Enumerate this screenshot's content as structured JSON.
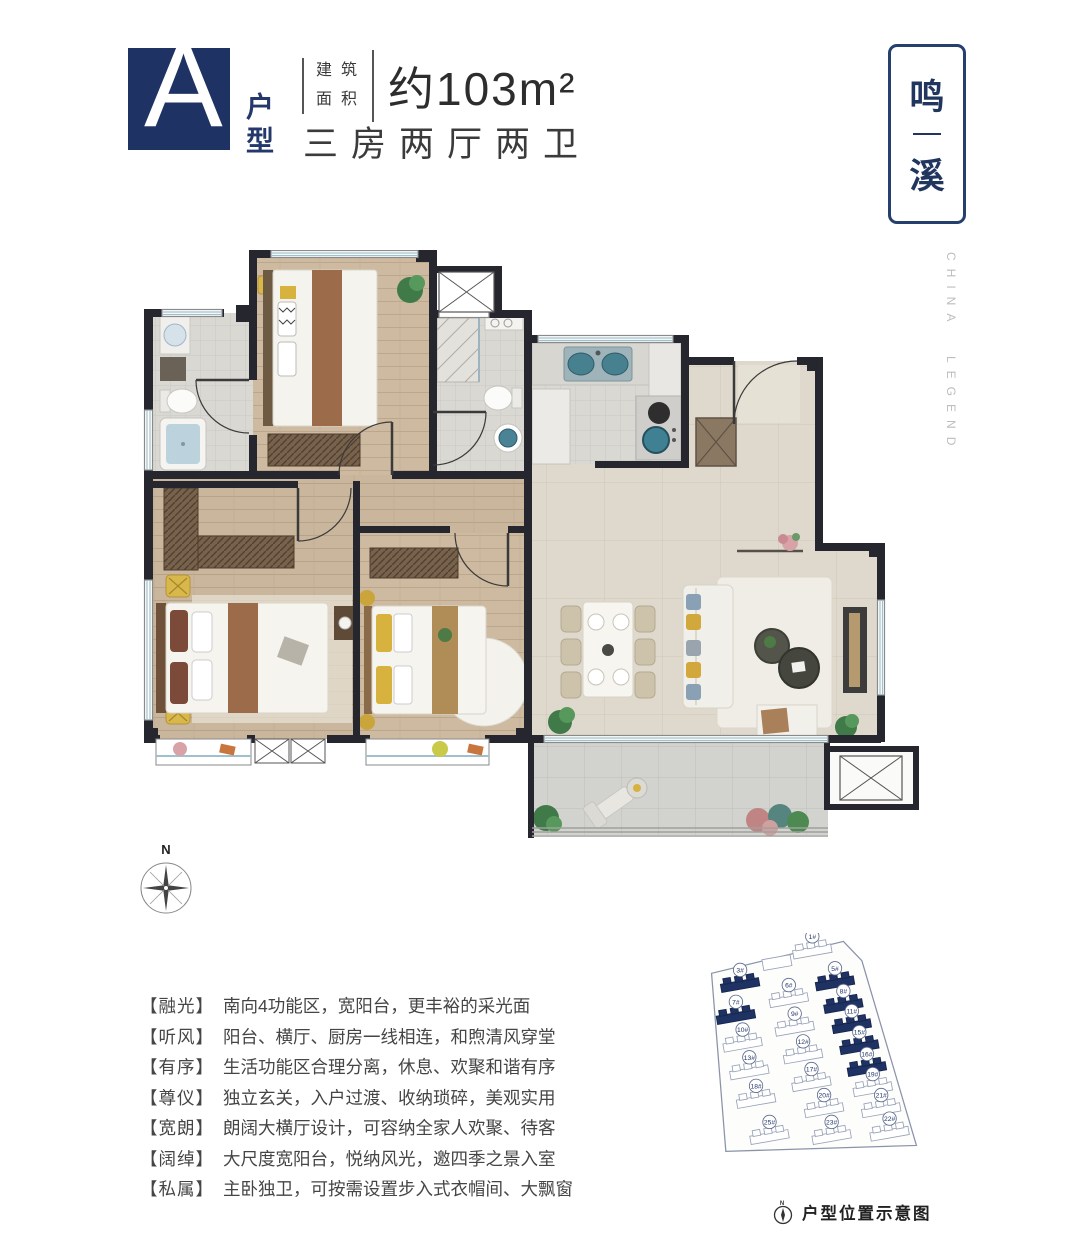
{
  "header": {
    "unit_letter": "A",
    "unit_type": "户型",
    "area_label_line1": "建筑",
    "area_label_line2": "面积",
    "area_value": "约103m²",
    "layout_text": "三房两厅两卫"
  },
  "brand": {
    "name_char1": "鸣",
    "name_char2": "溪",
    "side_text": "CHINA LEGEND"
  },
  "floorplan": {
    "compass_label": "N"
  },
  "features": [
    {
      "tag": "【融光】",
      "text": "南向4功能区，宽阳台，更丰裕的采光面"
    },
    {
      "tag": "【听风】",
      "text": "阳台、横厅、厨房一线相连，和煦清风穿堂"
    },
    {
      "tag": "【有序】",
      "text": "生活功能区合理分离，休息、欢聚和谐有序"
    },
    {
      "tag": "【尊仪】",
      "text": "独立玄关，入户过渡、收纳琐碎，美观实用"
    },
    {
      "tag": "【宽朗】",
      "text": "朗阔大横厅设计，可容纳全家人欢聚、待客"
    },
    {
      "tag": "【阔绰】",
      "text": "大尺度宽阳台，悦纳风光，邀四季之景入室"
    },
    {
      "tag": "【私属】",
      "text": "主卧独卫，可按需设置步入式衣帽间、大飘窗"
    }
  ],
  "siteplan": {
    "caption": "户型位置示意图",
    "compass_label": "N",
    "buildings": [
      {
        "label": "1#",
        "x": 148,
        "y": 22,
        "highlighted": false
      },
      {
        "label": "3#",
        "x": 62,
        "y": 62,
        "highlighted": true
      },
      {
        "label": "5#",
        "x": 175,
        "y": 60,
        "highlighted": true
      },
      {
        "label": "6#",
        "x": 120,
        "y": 80,
        "highlighted": false
      },
      {
        "label": "7#",
        "x": 57,
        "y": 100,
        "highlighted": true
      },
      {
        "label": "8#",
        "x": 185,
        "y": 87,
        "highlighted": true
      },
      {
        "label": "9#",
        "x": 127,
        "y": 114,
        "highlighted": false
      },
      {
        "label": "10#",
        "x": 65,
        "y": 133,
        "highlighted": false
      },
      {
        "label": "11#",
        "x": 195,
        "y": 111,
        "highlighted": true
      },
      {
        "label": "12#",
        "x": 137,
        "y": 147,
        "highlighted": false
      },
      {
        "label": "13#",
        "x": 73,
        "y": 166,
        "highlighted": false
      },
      {
        "label": "15#",
        "x": 204,
        "y": 136,
        "highlighted": true
      },
      {
        "label": "16#",
        "x": 213,
        "y": 162,
        "highlighted": true
      },
      {
        "label": "17#",
        "x": 147,
        "y": 180,
        "highlighted": false
      },
      {
        "label": "18#",
        "x": 81,
        "y": 200,
        "highlighted": false
      },
      {
        "label": "19#",
        "x": 220,
        "y": 186,
        "highlighted": false
      },
      {
        "label": "20#",
        "x": 162,
        "y": 211,
        "highlighted": false
      },
      {
        "label": "21#",
        "x": 230,
        "y": 211,
        "highlighted": false
      },
      {
        "label": "22#",
        "x": 240,
        "y": 239,
        "highlighted": false
      },
      {
        "label": "23#",
        "x": 171,
        "y": 243,
        "highlighted": false
      },
      {
        "label": "25#",
        "x": 97,
        "y": 243,
        "highlighted": false
      }
    ]
  },
  "colors": {
    "navy": "#1e3263",
    "border_navy": "#26406e",
    "wall": "#26262e",
    "teal": "#3e7f96",
    "wood": "#cbb79c",
    "tile": "#ded9cc"
  }
}
